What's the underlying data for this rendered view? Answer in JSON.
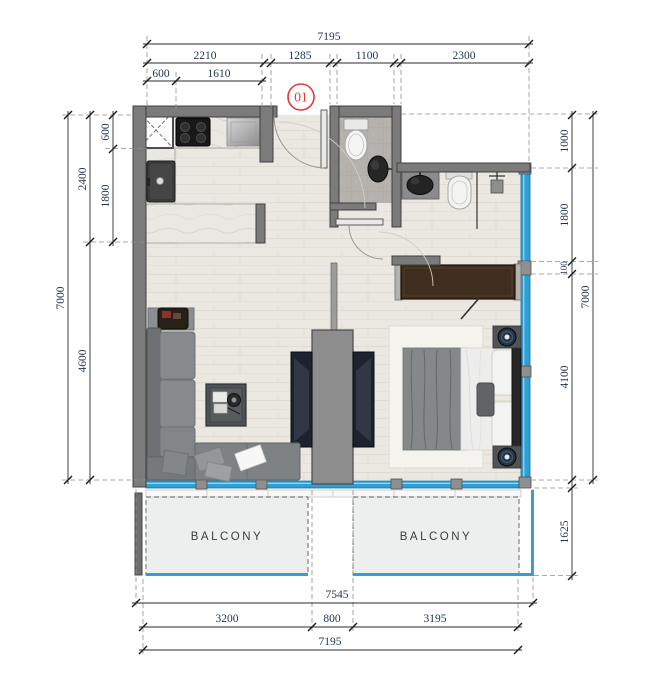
{
  "unit_label": "01",
  "rooms": {
    "balcony_left": "BALCONY",
    "balcony_right": "BALCONY"
  },
  "dims": {
    "top": {
      "total": "7195",
      "segments": [
        "2210",
        "1285",
        "1100",
        "2300"
      ],
      "sub": [
        "600",
        "1610"
      ]
    },
    "left": {
      "total": "7000",
      "mid": [
        "2400",
        "4600"
      ],
      "inner": [
        "600",
        "1800"
      ]
    },
    "right": {
      "total": "7000",
      "segments": [
        "1000",
        "1800",
        "100",
        "4100"
      ],
      "balcony": "1625"
    },
    "bottom": {
      "overall_outer": "7545",
      "segments": [
        "3200",
        "800",
        "3195"
      ],
      "overall": "7195"
    }
  },
  "colors": {
    "glass_blue": "#2f9fd4",
    "wall_gray": "#7b7b7b",
    "unit_red": "#e23b32",
    "dim_text": "#1f3350",
    "wood_floor": "#ebe8e1",
    "balcony_fill": "#edefef"
  }
}
